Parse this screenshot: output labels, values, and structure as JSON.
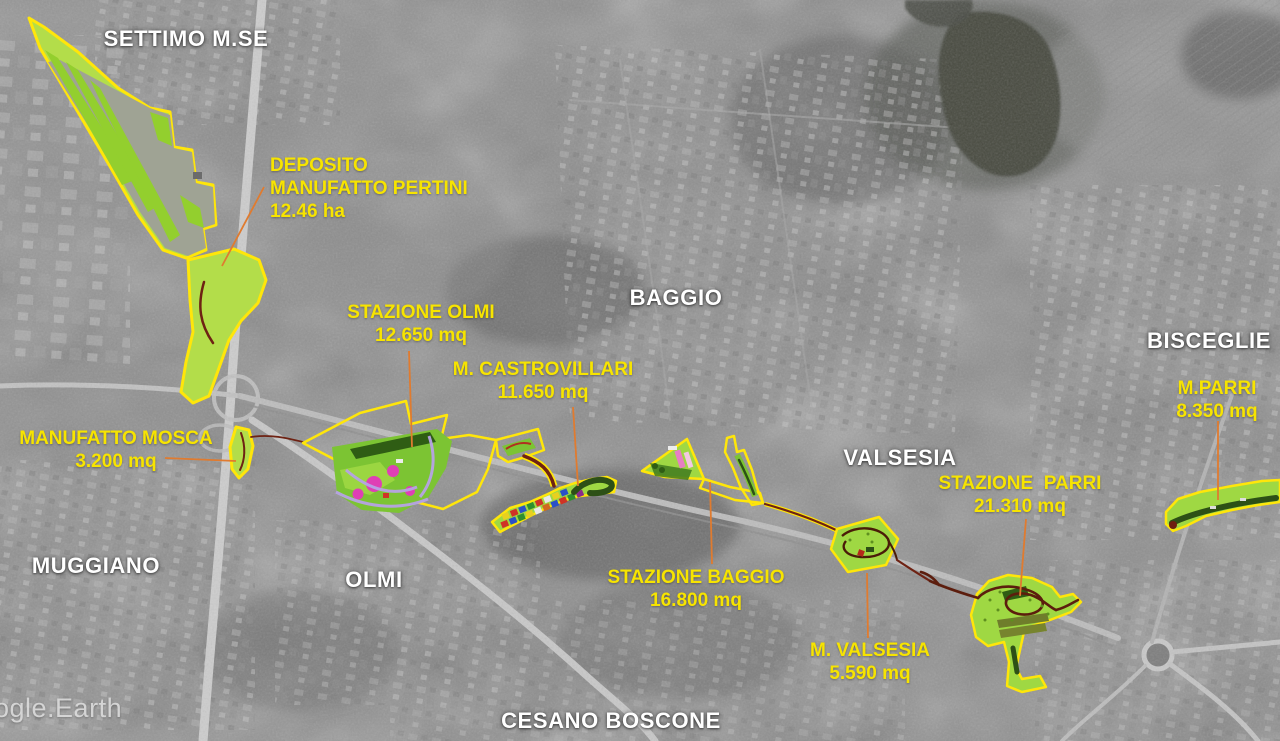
{
  "map": {
    "source_watermark": "ogle.Earth",
    "regions": [
      {
        "id": "settimo",
        "label": "SETTIMO M.SE"
      },
      {
        "id": "baggio",
        "label": "BAGGIO"
      },
      {
        "id": "bisceglie",
        "label": "BISCEGLIE"
      },
      {
        "id": "valsesia",
        "label": "VALSESIA"
      },
      {
        "id": "muggiano",
        "label": "MUGGIANO"
      },
      {
        "id": "olmi",
        "label": "OLMI"
      },
      {
        "id": "cesano",
        "label": "CESANO BOSCONE"
      }
    ],
    "sites": [
      {
        "id": "pertini",
        "name_line1": "DEPOSITO",
        "name_line2": "MANUFATTO PERTINI",
        "area": "12.46 ha"
      },
      {
        "id": "mosca",
        "name": "MANUFATTO MOSCA",
        "area": "3.200 mq"
      },
      {
        "id": "olmi",
        "name": "STAZIONE OLMI",
        "area": "12.650 mq"
      },
      {
        "id": "castrovillari",
        "name": "M. CASTROVILLARI",
        "area": "11.650 mq"
      },
      {
        "id": "baggio",
        "name": "STAZIONE BAGGIO",
        "area": "16.800 mq"
      },
      {
        "id": "valsesia",
        "name": "M. VALSESIA",
        "area": "5.590 mq"
      },
      {
        "id": "parri",
        "name": "STAZIONE  PARRI",
        "area": "21.310 mq"
      },
      {
        "id": "mparri",
        "name": "M.PARRI",
        "area": "8.350 mq"
      }
    ]
  },
  "colors": {
    "label_white": "#ffffff",
    "label_yellow": "#f7e400",
    "leader_orange": "#e07b2f",
    "area_fill_green": "#b3dd4a",
    "park_green": "#9fd843",
    "area_outline_yellow": "#ffe60a",
    "route_dark_red": "#6e2213",
    "path_dark_green": "#2d5016"
  }
}
